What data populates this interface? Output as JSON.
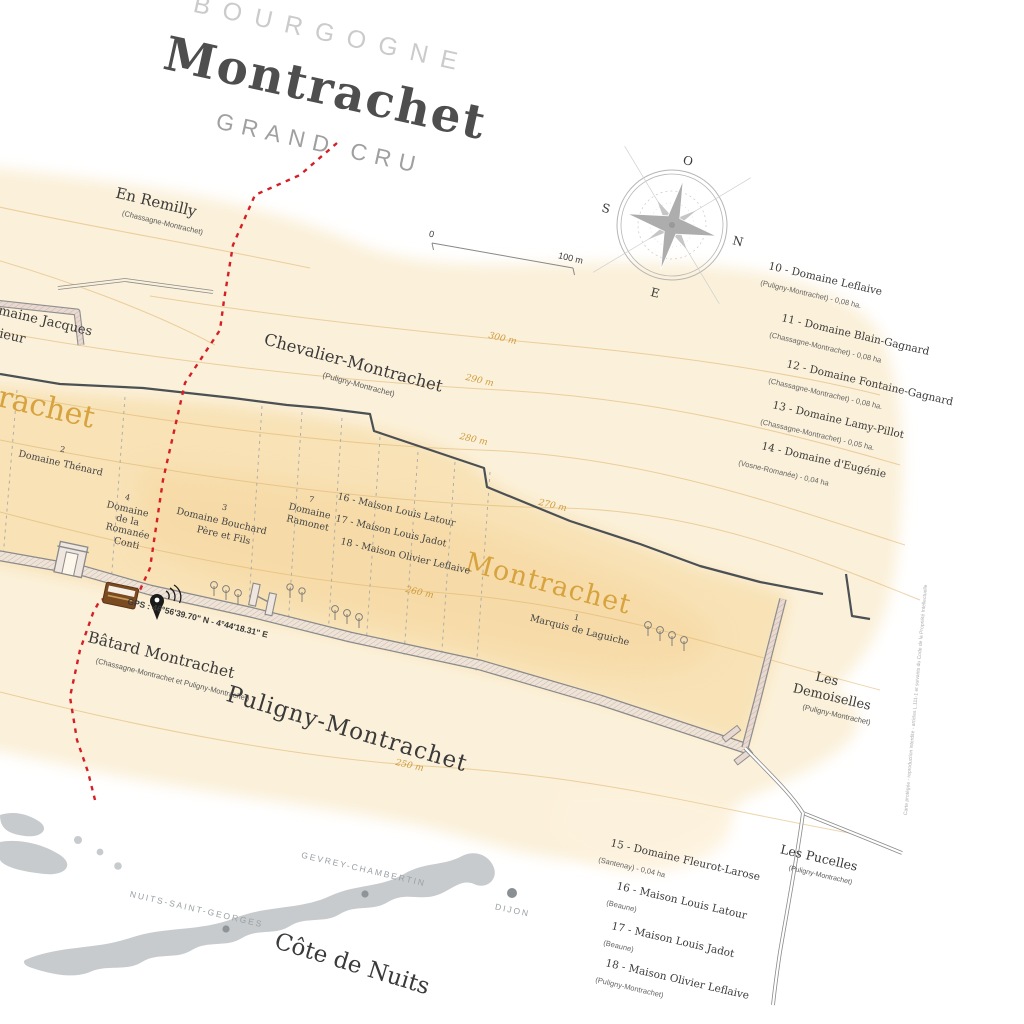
{
  "title": {
    "region": "BOURGOGNE",
    "name": "Montrachet",
    "classification": "GRAND CRU"
  },
  "compass": {
    "west": "O",
    "north": "N",
    "east": "E",
    "south": "S"
  },
  "scale": {
    "zero": "0",
    "hundred": "100 m"
  },
  "gps": "GPS : 46°56'39.70\" N - 4°44'18.31\" E",
  "communes": {
    "puligny": "Puligny-Montrachet"
  },
  "climats": {
    "en_remilly": {
      "name": "En Remilly",
      "commune": "(Chassagne-Montrachet)"
    },
    "chevalier": {
      "name": "Chevalier-Montrachet",
      "commune": "(Puligny-Montrachet)"
    },
    "montrachet_big": {
      "name": "Montrachet"
    },
    "montrachet_clipped": {
      "name": "Montrachet"
    },
    "batard": {
      "name": "Bâtard Montrachet",
      "commune": "(Chassagne-Montrachet et Puligny-Montrachet)"
    },
    "demoiselles": {
      "line1": "Les",
      "line2": "Demoiselles",
      "commune": "(Puligny-Montrachet)"
    },
    "pucelles": {
      "name": "Les Pucelles",
      "commune": "(Puligny-Montrachet)"
    }
  },
  "clipped_left": {
    "line1": "Domaine Jacques",
    "line2": "Prieur"
  },
  "parcels": [
    {
      "num": "2",
      "lines": [
        "Domaine Thénard"
      ]
    },
    {
      "num": "4",
      "lines": [
        "Domaine",
        "de la",
        "Romanée",
        "Conti"
      ]
    },
    {
      "num": "3",
      "lines": [
        "Domaine Bouchard",
        "Père et Fils"
      ]
    },
    {
      "num": "7",
      "lines": [
        "Domaine",
        "Ramonet"
      ]
    },
    {
      "num": "1",
      "lines": [
        "Marquis de Laguiche"
      ]
    }
  ],
  "maison_rows": [
    "16 - Maison Louis Latour",
    "17 - Maison Louis Jadot",
    "18 - Maison Olivier Leflaive"
  ],
  "legend_right": [
    {
      "title": "10 - Domaine Leflaive",
      "sub": "(Puligny-Montrachet) - 0,08 ha."
    },
    {
      "title": "11 - Domaine Blain-Gagnard",
      "sub": "(Chassagne-Montrachet) - 0,08 ha"
    },
    {
      "title": "12 - Domaine Fontaine-Gagnard",
      "sub": "(Chassagne-Montrachet) - 0,08 ha."
    },
    {
      "title": "13 - Domaine Lamy-Pillot",
      "sub": "(Chassagne-Montrachet) - 0,05 ha."
    },
    {
      "title": "14 - Domaine d'Eugénie",
      "sub": "(Vosne-Romanée) - 0,04 ha"
    }
  ],
  "legend_bottom": [
    {
      "title": "15 - Domaine Fleurot-Larose",
      "sub": "(Santenay) - 0,04 ha"
    },
    {
      "title": "16 - Maison Louis Latour",
      "sub": "(Beaune)"
    },
    {
      "title": "17 - Maison Louis Jadot",
      "sub": "(Beaune)"
    },
    {
      "title": "18 - Maison Olivier Leflaive",
      "sub": "(Puligny-Montrachet)"
    }
  ],
  "contours": [
    "300 m",
    "290 m",
    "280 m",
    "270 m",
    "260 m",
    "250 m"
  ],
  "inset": {
    "towns": [
      "GEVREY-CHAMBERTIN",
      "NUITS-SAINT-GEORGES",
      "DIJON"
    ],
    "region": "Côte de Nuits"
  },
  "fine_print": "Carte protégée - reproduction interdite - articles L.111-1 et suivants du Code de la Propriété Intellectuelle",
  "colors": {
    "gold": "#d7a33e",
    "boundary_red": "#d41f26",
    "commune_red": "#b01f2e",
    "cream": "#fbf0d9",
    "parcel_band": "#f8e2b5"
  }
}
